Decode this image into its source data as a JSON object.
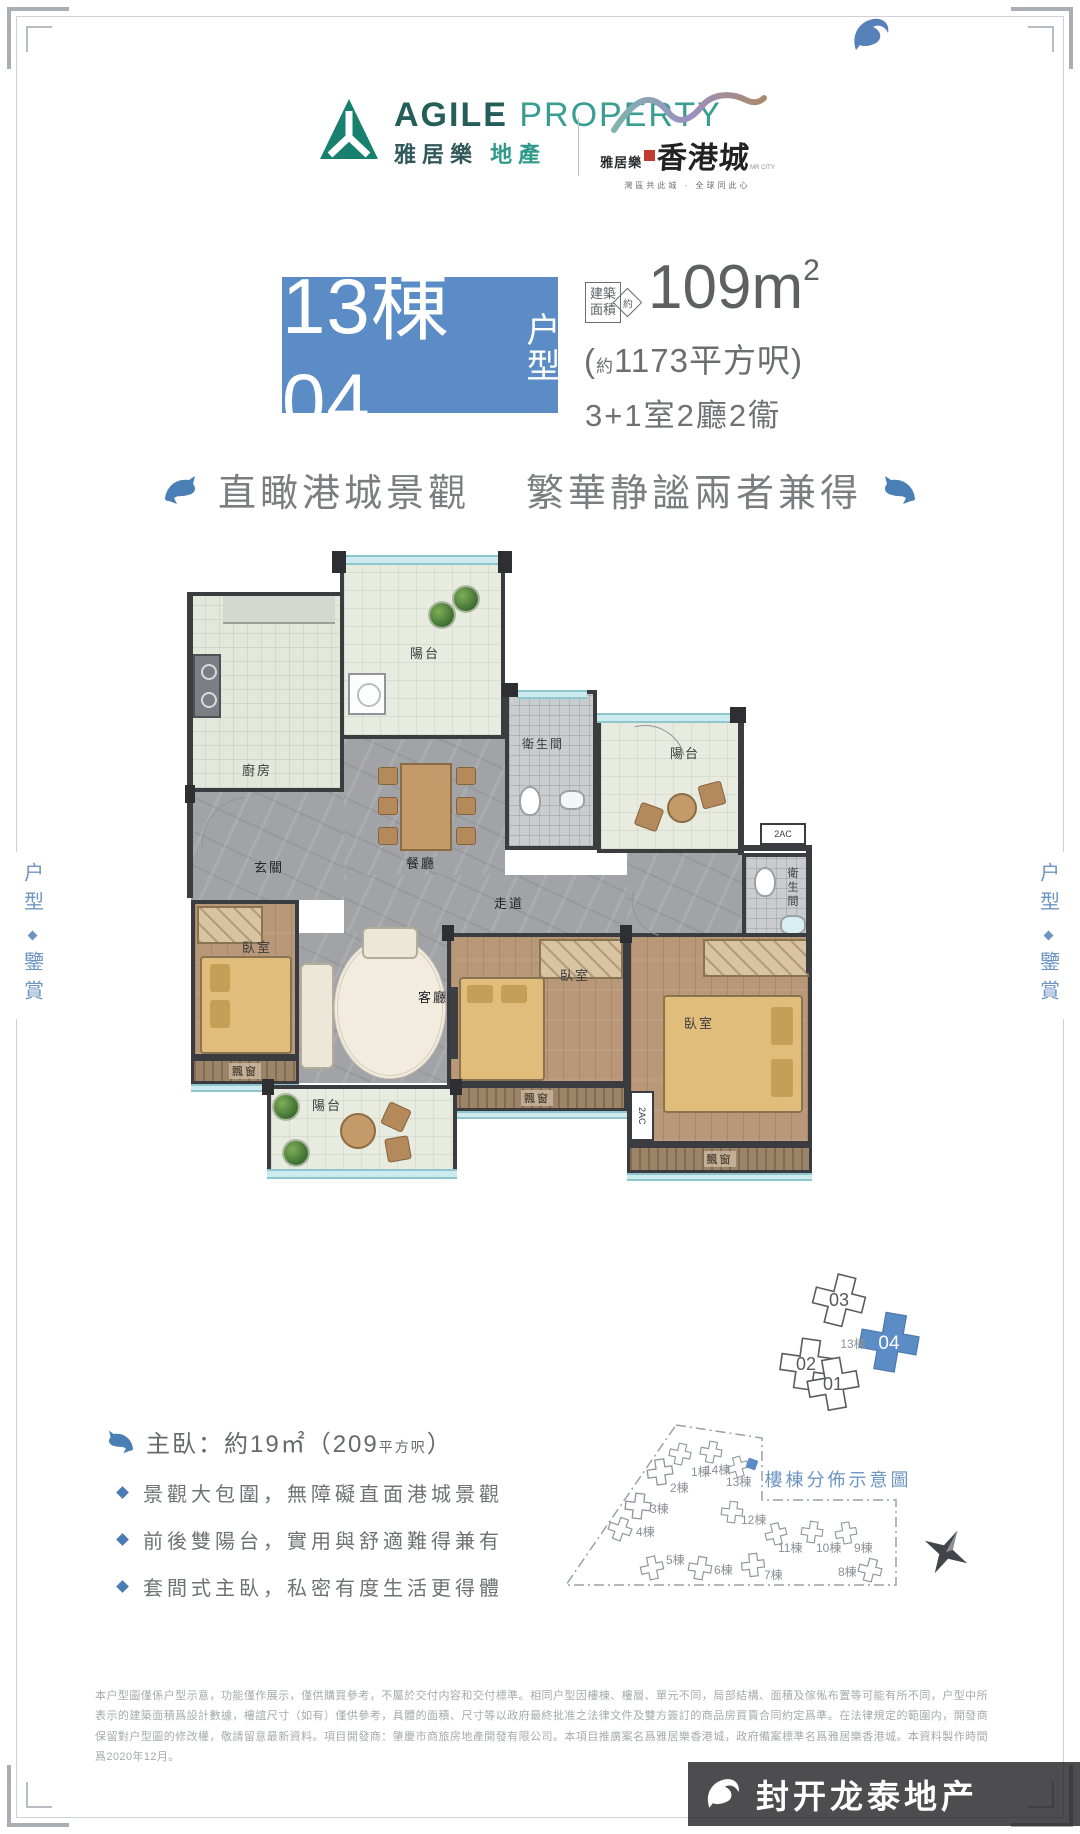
{
  "frame": {
    "side_top": "户型",
    "side_bottom": "鑒賞"
  },
  "header": {
    "agile": {
      "en1": "AGILE",
      "en2": "PROPERTY",
      "cn1": "雅居樂",
      "cn2": "地產"
    },
    "project": {
      "pre": "雅居樂",
      "name": "香港城",
      "sub": "MR CITY",
      "tagline": "灣區共此城 · 全球同此心"
    }
  },
  "spec": {
    "block": "13棟04",
    "block_suffix": "户型",
    "area_tag1": "建築",
    "area_tag2": "面積",
    "area_approx": "約",
    "area_m2": "109m",
    "area_sup": "2",
    "hk_open": "(",
    "hk_approx": "約",
    "hk_value": "1173平方呎)",
    "layout": "3+1室2廳2衞"
  },
  "slogan": {
    "p1": "直瞰港城景觀",
    "p2": "繁華静謐兩者兼得"
  },
  "floorplan": {
    "balcony": "陽台",
    "kitchen": "廚房",
    "dining": "餐廳",
    "bath": "衛生間",
    "foyer": "玄關",
    "corridor": "走道",
    "living": "客廳",
    "bedroom": "臥室",
    "bay_window": "飄窗",
    "ac": "2AC"
  },
  "keyplan": {
    "units": [
      "03",
      "02",
      "01",
      "04"
    ],
    "center": "13棟",
    "highlighted": "04"
  },
  "master_suite": {
    "label": "主臥：約19㎡",
    "paren": "（209",
    "unit": "平方呎",
    "close": "）"
  },
  "features": [
    "景觀大包圍，無障礙直面港城景觀",
    "前後雙陽台，實用與舒適難得兼有",
    "套間式主臥，私密有度生活更得體"
  ],
  "siteplan": {
    "title": "樓棟分佈示意圖",
    "buildings": [
      "1棟",
      "2棟",
      "3棟",
      "4棟",
      "5棟",
      "6棟",
      "7棟",
      "8棟",
      "9棟",
      "10棟",
      "11棟",
      "12棟",
      "13棟",
      "14棟"
    ]
  },
  "disclaimer": "本户型圖僅係户型示意，功能僅作展示，僅供購買參考，不屬於交付内容和交付標準。相同户型因樓棟、樓層、單元不同，局部結構、面積及傢俬布置等可能有所不同，户型中所表示的建築面積爲設計數據，樓誼尺寸（如有）僅供參考，具體的面積、尺寸等以政府最終批准之法律文件及雙方簽訂的商品房買賣合同約定爲準。在法律規定的範圍内，開發商保留對户型圖的修改權，敬請留意最新資料。項目開發商：肇慶市商旅房地產開發有限公司。本項目推廣案名爲雅居樂香港城，政府備案標準名爲雅居樂香港城。本資料製作時間爲2020年12月。",
  "watermark": "封开龙泰地产",
  "colors": {
    "accent_blue": "#5b8cc6",
    "brand_teal": "#2f9a8a",
    "feature_blue": "#4a7cb5"
  }
}
